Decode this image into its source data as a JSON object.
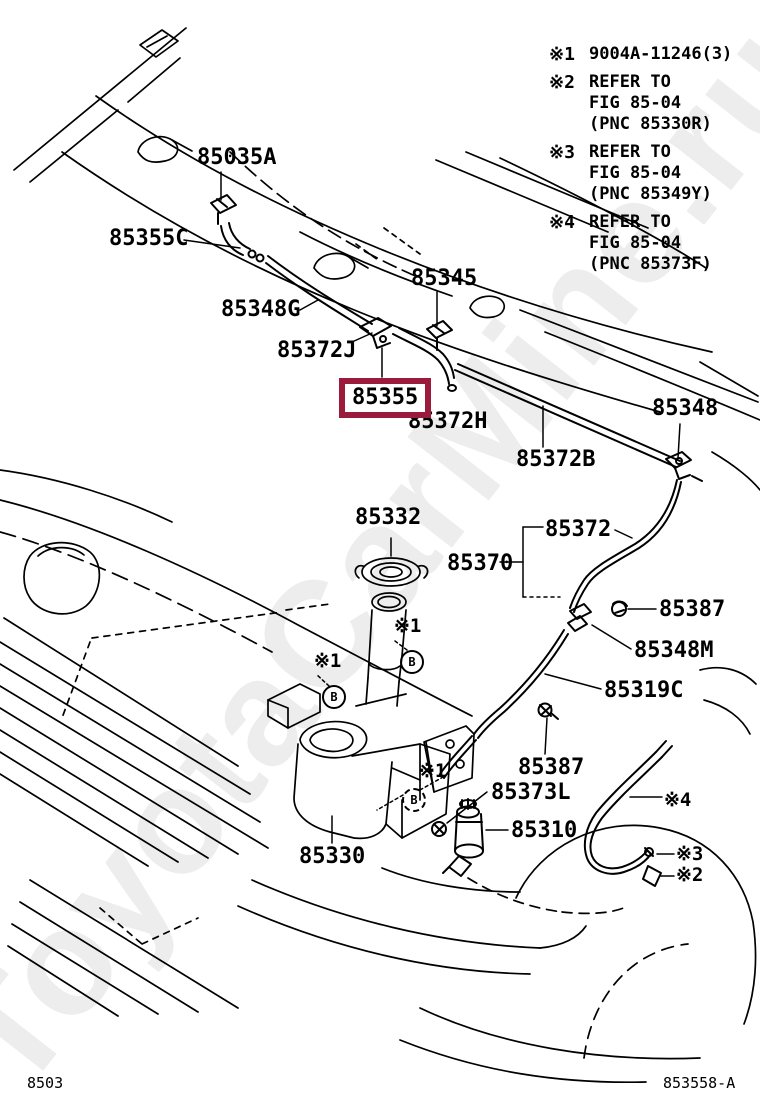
{
  "watermark": "ToyotaCarMine.ru",
  "notes": [
    {
      "marker": "※1",
      "text": "9004A-11246(3)"
    },
    {
      "marker": "※2",
      "text": "REFER TO\nFIG 85-04\n(PNC 85330R)"
    },
    {
      "marker": "※3",
      "text": "REFER TO\nFIG 85-04\n(PNC 85349Y)"
    },
    {
      "marker": "※4",
      "text": "REFER TO\nFIG 85-04\n(PNC 85373F)"
    }
  ],
  "labels": {
    "nozzle_left": "85035A",
    "joint_85355c": "85355C",
    "hose_85348g": "85348G",
    "nozzle_right": "85345",
    "hose_85372j": "85372J",
    "highlighted": "85355",
    "hose_85372h": "85372H",
    "hose_85372b": "85372B",
    "connector_85348": "85348",
    "cap_85332": "85332",
    "assy_85370": "85370",
    "hose_85372": "85372",
    "screw_85387": "85387",
    "joint_85348m": "85348M",
    "hose_85319c": "85319C",
    "clamp_85387": "85387",
    "grommet_85373l": "85373L",
    "pump_85310": "85310",
    "jar_85330": "85330"
  },
  "ref_markers": {
    "star1": "※1",
    "star2": "※2",
    "star3": "※3",
    "star4": "※4",
    "circle_b": "B"
  },
  "footer": {
    "page_code": "8503",
    "figure_code": "853558-A"
  },
  "colors": {
    "highlight_border": "#9B1B3D",
    "line": "#000000",
    "watermark": "#EDEDED",
    "background": "#FFFFFF"
  }
}
